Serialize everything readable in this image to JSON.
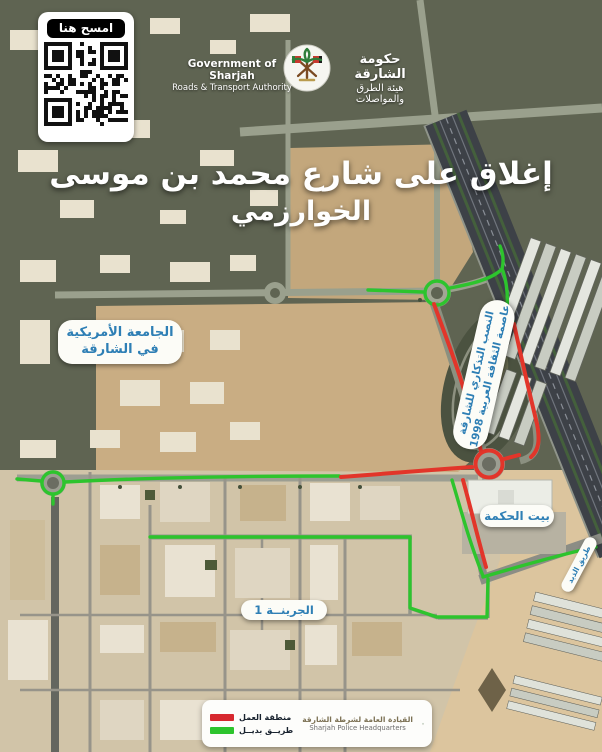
{
  "qr": {
    "label": "امسح هنا"
  },
  "header": {
    "gov_en_line1": "Government of Sharjah",
    "gov_en_line2": "Roads & Transport Authority",
    "gov_ar_line1": "حكومة الشارقة",
    "gov_ar_line2": "هيئة الطرق والمواصلات"
  },
  "title": {
    "line1": "إغلاق على شارع محمد بن موسى",
    "line2": "الخوارزمي"
  },
  "map_labels": {
    "aus_line1": "الجامعة الأمريكية",
    "aus_line2": "في الشارقة",
    "monument_line1": "النصب التذكاري للشارقة",
    "monument_line2": "عاصمة الثقافة العربية 1998",
    "bait_al_hikma": "بيت الحكمة",
    "al_dhaid_road": "طريق الذيد",
    "al_juraina": "الجرينــة 1"
  },
  "legend": {
    "work_zone_label": "منطقة العمل",
    "alt_route_label": "طريــق بديــل",
    "police_ar": "القيادة العامة لشرطة الشارقة",
    "police_en": "Sharjah Police Headquarters"
  },
  "colors": {
    "work_zone": "#d7282f",
    "alt_route": "#2dc42d",
    "label_blue": "#2e7fb5"
  }
}
